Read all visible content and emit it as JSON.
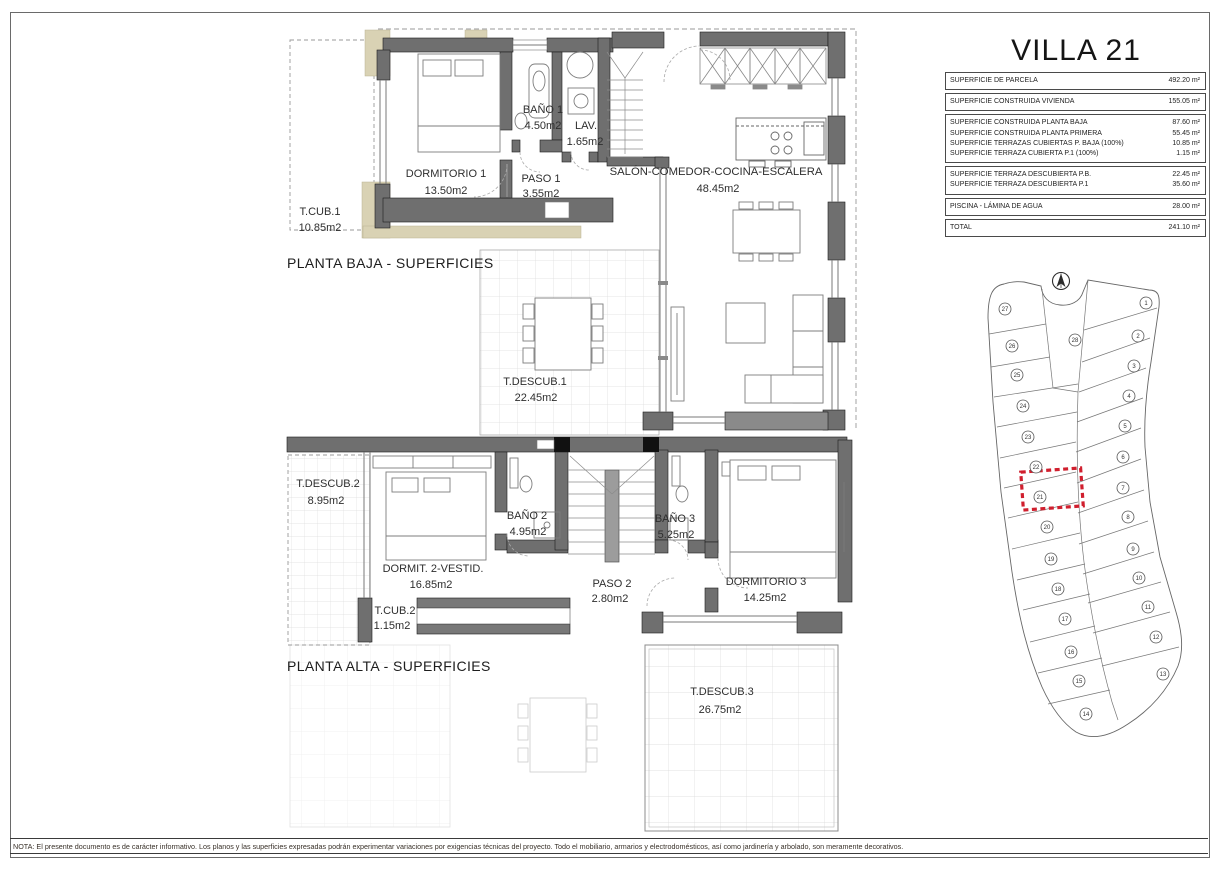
{
  "header": {
    "title": "VILLA 21"
  },
  "table": {
    "groups": [
      {
        "rows": [
          {
            "label": "SUPERFICIE DE PARCELA",
            "value": "492.20 m²"
          }
        ]
      },
      {
        "rows": [
          {
            "label": "SUPERFICIE CONSTRUIDA VIVIENDA",
            "value": "155.05 m²"
          }
        ]
      },
      {
        "rows": [
          {
            "label": "SUPERFICIE CONSTRUIDA PLANTA BAJA",
            "value": "87.60 m²"
          },
          {
            "label": "SUPERFICIE CONSTRUIDA PLANTA PRIMERA",
            "value": "55.45 m²"
          },
          {
            "label": "SUPERFICIE TERRAZAS CUBIERTAS P. BAJA (100%)",
            "value": "10.85 m²"
          },
          {
            "label": "SUPERFICIE TERRAZA CUBIERTA P.1 (100%)",
            "value": "1.15 m²"
          }
        ]
      },
      {
        "rows": [
          {
            "label": "SUPERFICIE TERRAZA DESCUBIERTA P.B.",
            "value": "22.45 m²"
          },
          {
            "label": "SUPERFICIE TERRAZA DESCUBIERTA P.1",
            "value": "35.60 m²"
          }
        ]
      },
      {
        "rows": [
          {
            "label": "PISCINA - LÁMINA DE AGUA",
            "value": "28.00 m²"
          }
        ]
      },
      {
        "rows": [
          {
            "label": "TOTAL",
            "value": "241.10 m²"
          }
        ]
      }
    ]
  },
  "ground": {
    "title": "PLANTA BAJA - SUPERFICIES",
    "rooms": {
      "tcub1": {
        "name": "T.CUB.1",
        "area": "10.85m2"
      },
      "dorm1": {
        "name": "DORMITORIO 1",
        "area": "13.50m2"
      },
      "bano1": {
        "name": "BAÑO 1",
        "area": "4.50m2"
      },
      "lav": {
        "name": "LAV.",
        "area": "1.65m2"
      },
      "paso1": {
        "name": "PASO 1",
        "area": "3.55m2"
      },
      "salon": {
        "name": "SALÓN-COMEDOR-COCINA-ESCALERA",
        "area": "48.45m2"
      },
      "tdescub1": {
        "name": "T.DESCUB.1",
        "area": "22.45m2"
      }
    }
  },
  "upper": {
    "title": "PLANTA ALTA - SUPERFICIES",
    "rooms": {
      "tdescub2": {
        "name": "T.DESCUB.2",
        "area": "8.95m2"
      },
      "dorm2": {
        "name": "DORMIT. 2-VESTID.",
        "area": "16.85m2"
      },
      "bano2": {
        "name": "BAÑO 2",
        "area": "4.95m2"
      },
      "bano3": {
        "name": "BAÑO 3",
        "area": "5.25m2"
      },
      "paso2": {
        "name": "PASO 2",
        "area": "2.80m2"
      },
      "dorm3": {
        "name": "DORMITORIO 3",
        "area": "14.25m2"
      },
      "tcub2": {
        "name": "T.CUB.2",
        "area": "1.15m2"
      },
      "tdescub3": {
        "name": "T.DESCUB.3",
        "area": "26.75m2"
      }
    }
  },
  "site": {
    "highlighted_plot": "21",
    "plots": [
      "1",
      "2",
      "3",
      "4",
      "5",
      "6",
      "7",
      "8",
      "9",
      "10",
      "11",
      "12",
      "13",
      "14",
      "15",
      "16",
      "17",
      "18",
      "19",
      "20",
      "21",
      "22",
      "23",
      "24",
      "25",
      "26",
      "27",
      "28"
    ]
  },
  "note": {
    "text": "NOTA: El presente documento es de carácter informativo. Los planos y las superficies expresadas podrán experimentar variaciones por exigencias técnicas del proyecto. Todo el mobiliario, armarios y electrodomésticos, así como jardinería y arbolado, son meramente decorativos."
  },
  "colors": {
    "wall": "#6f6f6f",
    "terrace_hatch": "#d9d2b4",
    "highlight": "#d01f2e"
  }
}
